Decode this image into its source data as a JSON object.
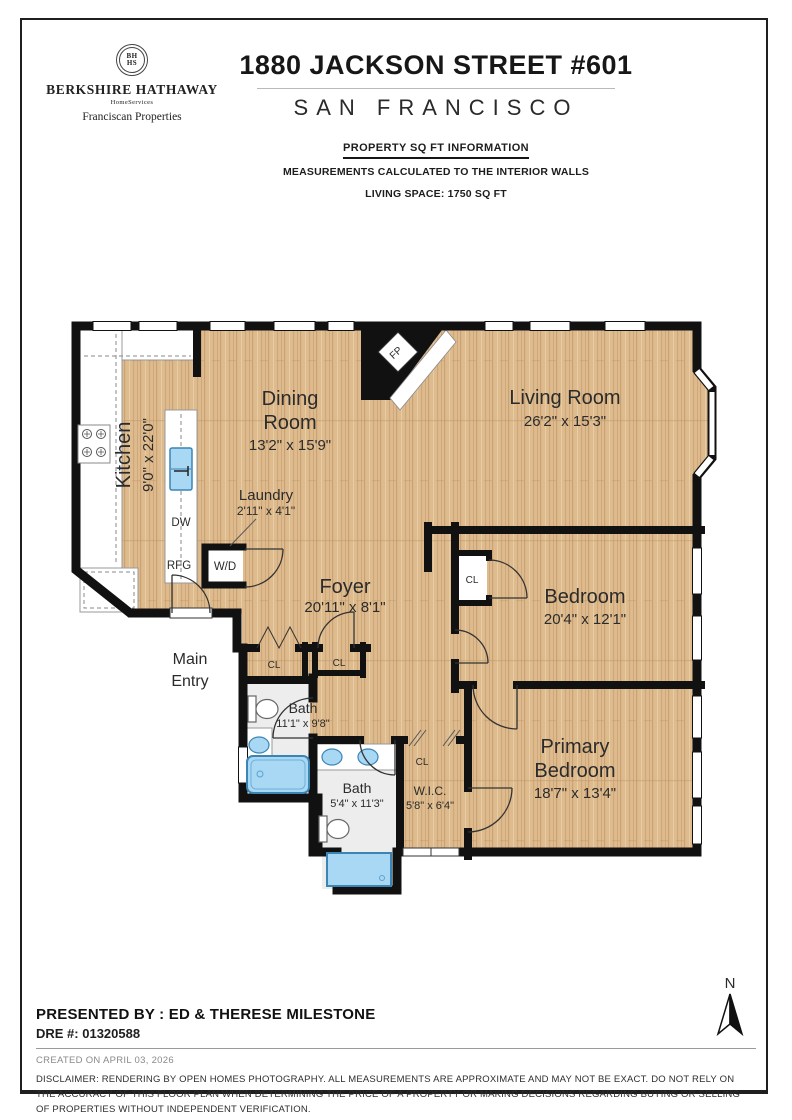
{
  "brand": {
    "seal_top": "BH",
    "seal_bottom": "HS",
    "name": "BERKSHIRE HATHAWAY",
    "homeservices": "HomeServices",
    "division": "Franciscan Properties"
  },
  "header": {
    "address": "1880 JACKSON STREET #601",
    "city": "SAN FRANCISCO",
    "sqft_title": "PROPERTY SQ FT INFORMATION",
    "sqft_note": "MEASUREMENTS CALCULATED TO THE INTERIOR WALLS",
    "living_space": "LIVING SPACE: 1750 SQ FT"
  },
  "plan": {
    "kitchen_name": "Kitchen",
    "kitchen_dims": "9'0\" x 22'0\"",
    "dining_name1": "Dining",
    "dining_name2": "Room",
    "dining_dims": "13'2\" x 15'9\"",
    "living_name": "Living Room",
    "living_dims": "26'2\" x 15'3\"",
    "laundry_name": "Laundry",
    "laundry_dims": "2'11\" x 4'1\"",
    "foyer_name": "Foyer",
    "foyer_dims": "20'11\" x 8'1\"",
    "main_entry1": "Main",
    "main_entry2": "Entry",
    "bath1_name": "Bath",
    "bath1_dims": "11'1\" x 9'8\"",
    "bath2_name": "Bath",
    "bath2_dims": "5'4\" x 11'3\"",
    "wic_name": "W.I.C.",
    "wic_dims": "5'8\" x 6'4\"",
    "bedroom_name": "Bedroom",
    "bedroom_dims": "20'4\" x 12'1\"",
    "primary_name1": "Primary",
    "primary_name2": "Bedroom",
    "primary_dims": "18'7\" x 13'4\"",
    "label_dw": "DW",
    "label_rfg": "RFG",
    "label_wd": "W/D",
    "label_fp": "FP",
    "label_cl": "CL"
  },
  "colors": {
    "wall": "#111111",
    "wood_base": "#debb8e",
    "fixture_blue": "#a8d8f4",
    "bath_floor": "#ededed"
  },
  "compass": {
    "north": "N"
  },
  "footer": {
    "presented_by": "PRESENTED BY : ED & THERESE MILESTONE",
    "dre": "DRE #: 01320588",
    "created": "CREATED ON APRIL 03, 2026",
    "disclaimer": "DISCLAIMER: RENDERING BY OPEN HOMES PHOTOGRAPHY. ALL MEASUREMENTS ARE APPROXIMATE AND MAY NOT BE EXACT. DO NOT RELY ON THE ACCURACY OF THIS FLOOR PLAN WHEN DETERMINING THE PRICE OF A PROPERTY OR MAKING DECISIONS REGARDING BUYING OR SELLING OF PROPERTIES WITHOUT INDEPENDENT VERIFICATION."
  }
}
